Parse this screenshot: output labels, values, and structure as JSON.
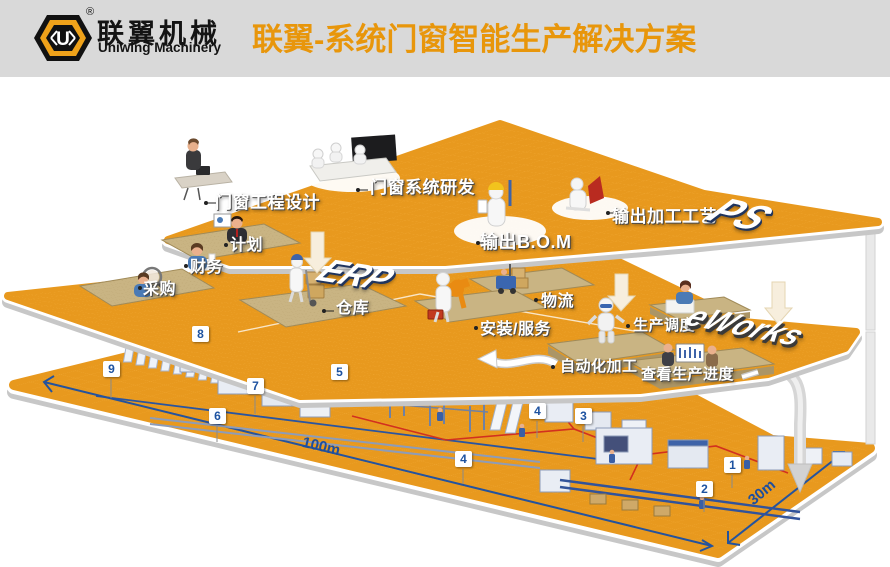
{
  "header": {
    "logo_letter": "U",
    "registered": "®",
    "brand_cn": "联翼机械",
    "brand_en": "Uniwing Machinery",
    "title": "联翼-系统门窗智能生产解决方案"
  },
  "colors": {
    "platform_orange": "#E8991E",
    "title_orange": "#E8960B",
    "header_gray": "#D9D9D9",
    "badge_blue": "#1D52A0",
    "dim_blue": "#1D4E9E",
    "flow_red": "#D2301F"
  },
  "platforms": {
    "top": {
      "logo": "PS",
      "labels": {
        "design": "门窗工程设计",
        "rnd": "门窗系统研发",
        "bom": "输出B.O.M",
        "craft": "输出加工工艺"
      }
    },
    "middle": {
      "logo_erp": "ERP",
      "logo_eworks": "eWorks",
      "labels": {
        "plan": "计划",
        "finance": "财务",
        "purchase": "采购",
        "warehouse": "仓库",
        "logistics": "物流",
        "install": "安装/服务",
        "dispatch": "生产调度",
        "auto": "自动化加工",
        "progress": "查看生产进度"
      }
    },
    "floor": {
      "badges": [
        "1",
        "2",
        "3",
        "4",
        "4",
        "5",
        "6",
        "7",
        "8",
        "9"
      ],
      "dim_length": "100m",
      "dim_width": "30m"
    }
  }
}
